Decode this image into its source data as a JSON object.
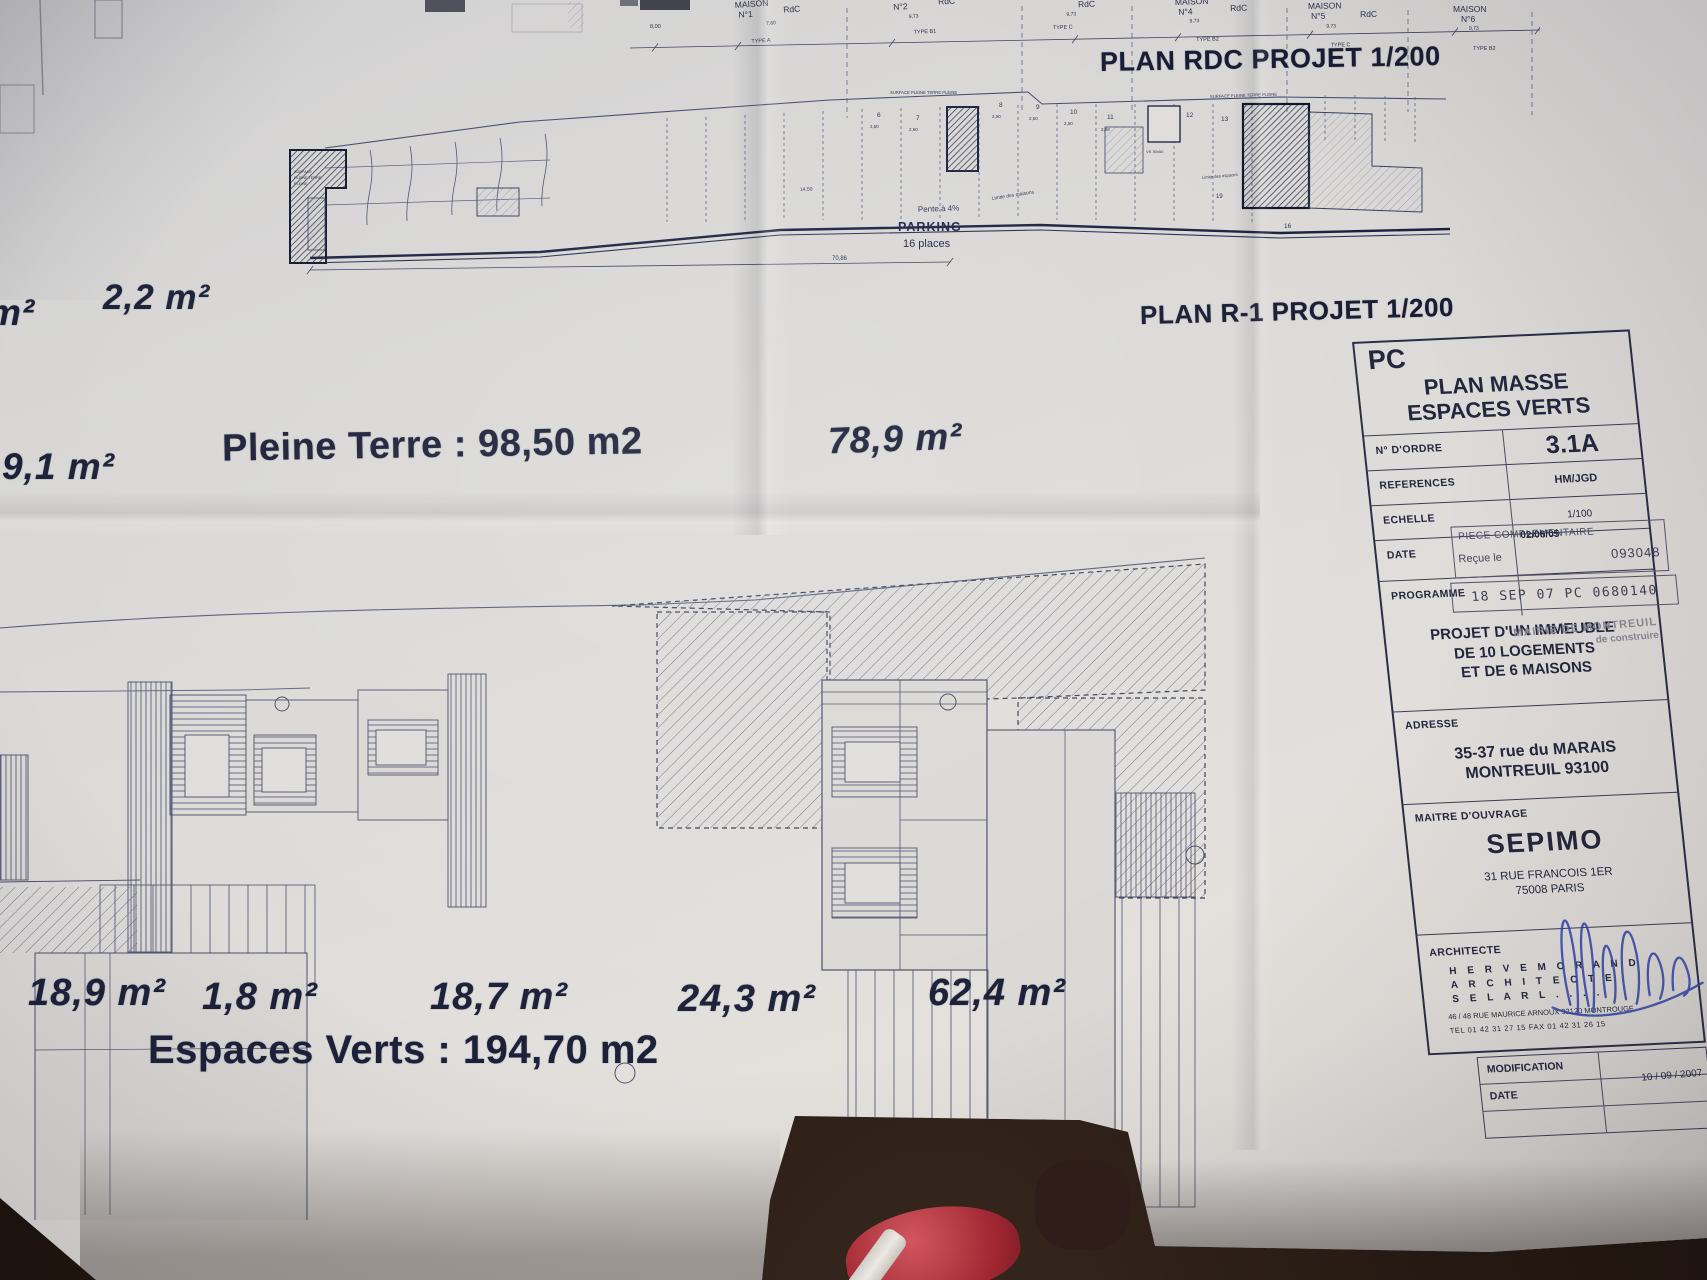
{
  "colors": {
    "ink": "#23263d",
    "paper": "#dcdad7",
    "signature_blue": "#3347b0",
    "stamp_gray": "#6a6a78",
    "red_item": "#b5303e"
  },
  "plan_rdc": {
    "title": "PLAN RDC PROJET 1/200",
    "dim_left": "8,00",
    "maisons": [
      {
        "maison": "MAISON",
        "num": "N°1",
        "level": "RdC",
        "dim": "7,60",
        "type": "TYPE A"
      },
      {
        "maison": "",
        "num": "N°2",
        "level": "RdC",
        "dim": "9,73",
        "type": "TYPE B1"
      },
      {
        "maison": "",
        "num": "",
        "level": "RdC",
        "dim": "9,73",
        "type": "TYPE C"
      },
      {
        "maison": "MAISON",
        "num": "N°4",
        "level": "RdC",
        "dim": "9,73",
        "type": "TYPE B2"
      },
      {
        "maison": "MAISON",
        "num": "N°5",
        "level": "RdC",
        "dim": "9,73",
        "type": "TYPE C"
      },
      {
        "maison": "MAISON",
        "num": "N°6",
        "level": "RdC",
        "dim": "9,73",
        "type": "TYPE B2"
      }
    ],
    "stalls": [
      "6",
      "7",
      "8",
      "9",
      "10",
      "11",
      "12",
      "13"
    ],
    "stall_dims": [
      "2,50",
      "2,60",
      "2,50",
      "2,50",
      "2,50",
      "2,98"
    ],
    "right_nums": [
      "19",
      "16"
    ],
    "parking_title": "PARKING",
    "parking_places": "16 places",
    "pente": "Pente à 4%",
    "limite_maisons": "Limite des maisons",
    "limite_espaces": "Limite des espaces",
    "dim_total": "70,86",
    "dim_mid": "14,50",
    "vs_label": "VS 30x50",
    "surface_center": "SURFACE PLEINE TERRE PLEINE",
    "surface_right": "SURFACE PLEINE TERRE PLEINE",
    "surface_left": [
      "SURFACE",
      "PLEINE TERRE",
      "PLEINE"
    ]
  },
  "plan_r1": {
    "title": "PLAN R-1 PROJET 1/200"
  },
  "areas": {
    "edge_partial": "m²",
    "top_small": "2,2 m²",
    "mid_small": "9,1 m²",
    "pleine_terre": "Pleine Terre : 98,50 m2",
    "right_mid": "78,9 m²",
    "bottom": [
      "18,9 m²",
      "1,8 m²",
      "18,7 m²",
      "24,3 m²",
      "62,4 m²"
    ],
    "espaces_verts": "Espaces Verts : 194,70 m2"
  },
  "cartouche": {
    "doc_type": "PC",
    "title1": "PLAN MASSE",
    "title2": "ESPACES VERTS",
    "ordre_label": "N° D'ORDRE",
    "ordre_value": "3.1A",
    "ref_label": "REFERENCES",
    "ref_value": "HM/JGD",
    "echelle_label": "ECHELLE",
    "echelle_value": "1/100",
    "date_label": "DATE",
    "date_value": "02/06/05",
    "prog_label": "PROGRAMME",
    "prog_line1": "PROJET D'UN IMMEUBLE",
    "prog_line2": "DE 10 LOGEMENTS",
    "prog_line3": "ET DE 6 MAISONS",
    "stamp_piece_l1": "PIECE COMPLEMENTAIRE",
    "stamp_piece_l2": "Reçue le",
    "stamp_piece_num": "093048",
    "stamp_pc": "18 SEP 07 PC 0680140",
    "stamp_mairie_l1": "MAIRIE DE MONTREUIL",
    "stamp_mairie_l2": "de construire",
    "adresse_label": "ADRESSE",
    "adresse1": "35-37 rue du MARAIS",
    "adresse2": "MONTREUIL 93100",
    "moa_label": "MAITRE D'OUVRAGE",
    "moa_name": "SEPIMO",
    "moa_addr1": "31 RUE FRANCOIS 1ER",
    "moa_addr2": "75008 PARIS",
    "arch_label": "ARCHITECTE",
    "arch_l1": "H E R V E    M O R A N D",
    "arch_l2": "A R C H I T E C T E",
    "arch_l3": "S E L A R L  .  .  .  .",
    "arch_addr": "46 / 48  RUE  MAURICE  ARNOUX     92120  MONTROUGE",
    "arch_tel": "TEL  01 42 31 27 15        FAX  01 42 31 26 15",
    "modif_label": "MODIFICATION",
    "modif_date_label": "DATE",
    "modif_date_value": "10 / 09 / 2007"
  }
}
